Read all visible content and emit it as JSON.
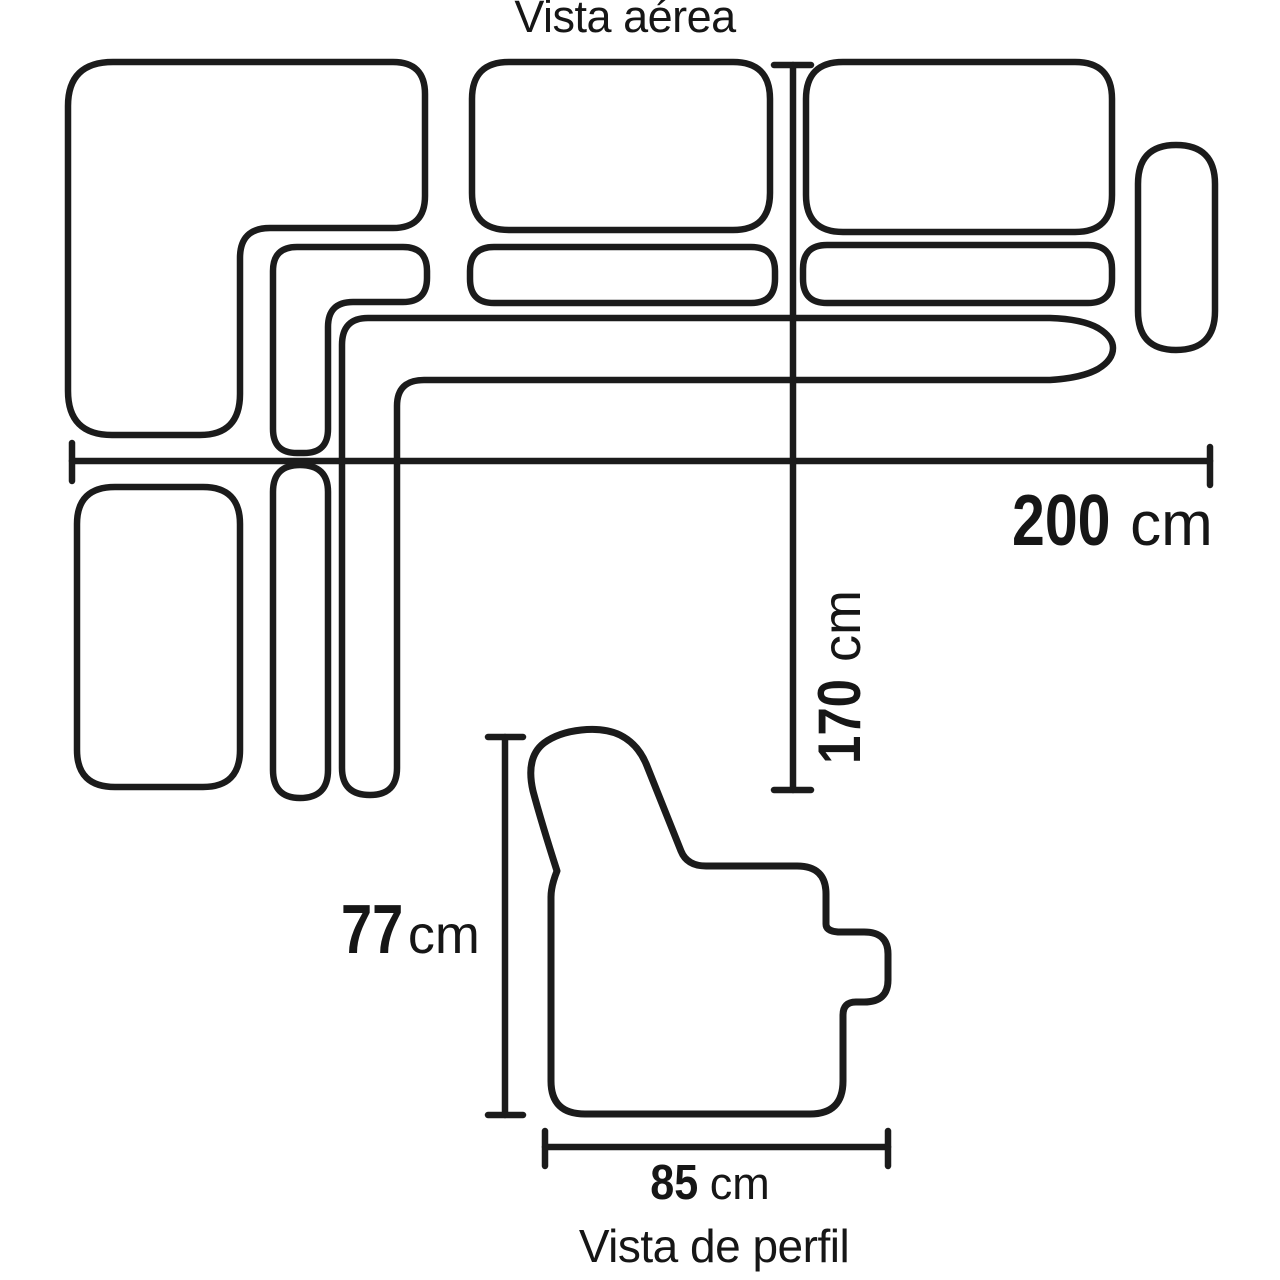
{
  "aerial": {
    "title": "Vista aérea",
    "width_dim": {
      "value": "200",
      "unit": "cm"
    },
    "depth_dim": {
      "value": "170",
      "unit": "cm"
    }
  },
  "profile": {
    "title": "Vista de perfil",
    "height_dim": {
      "value": "77",
      "unit": "cm"
    },
    "seat_depth_dim": {
      "value": "85",
      "unit": "cm"
    }
  },
  "colors": {
    "line": "#1b1b1b",
    "text": "#161616",
    "background": "#ffffff"
  }
}
